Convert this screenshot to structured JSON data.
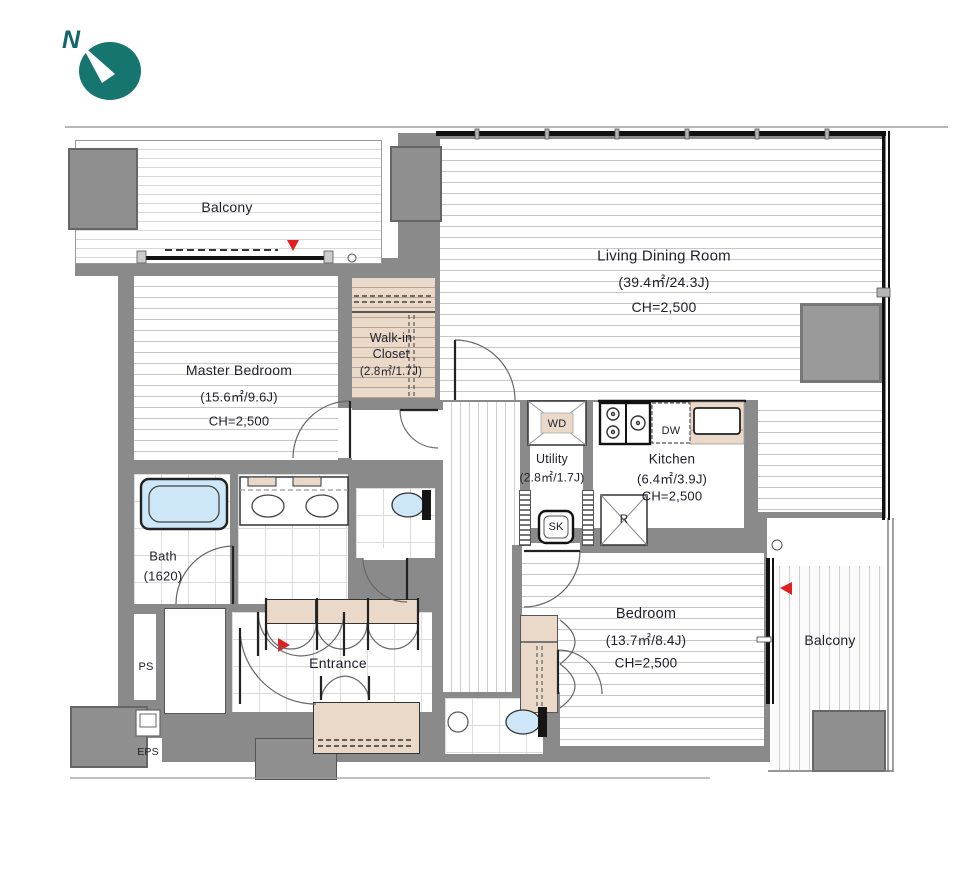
{
  "compass": {
    "label": "N"
  },
  "rooms": {
    "balcony_top": {
      "name": "Balcony"
    },
    "living_dining": {
      "name": "Living Dining Room",
      "area": "(39.4㎡/24.3J)",
      "ceiling_height": "CH=2,500"
    },
    "master_bedroom": {
      "name": "Master Bedroom",
      "area": "(15.6㎡/9.6J)",
      "ceiling_height": "CH=2,500"
    },
    "walk_in_closet": {
      "name_line1": "Walk-in",
      "name_line2": "Closet",
      "area": "(2.8㎡/1.7J)"
    },
    "utility": {
      "name": "Utility",
      "area": "(2.8㎡/1.7J)"
    },
    "kitchen": {
      "name": "Kitchen",
      "area": "(6.4㎡/3.9J)",
      "ceiling_height": "CH=2,500"
    },
    "bath": {
      "name": "Bath",
      "size": "(1620)"
    },
    "entrance": {
      "name": "Entrance"
    },
    "bedroom": {
      "name": "Bedroom",
      "area": "(13.7㎡/8.4J)",
      "ceiling_height": "CH=2,500"
    },
    "balcony_right": {
      "name": "Balcony"
    },
    "ps": {
      "name": "PS"
    },
    "eps": {
      "name": "EPS"
    }
  },
  "fixtures": {
    "washer_dryer": "WD",
    "dishwasher": "DW",
    "slop_sink": "SK",
    "refrigerator": "R"
  },
  "colors": {
    "wall": "#8a8a8a",
    "counter_beige": "#ead9c8",
    "fixture_blue": "#cde7f8",
    "compass_teal": "#16766f",
    "arrow_red": "#e02020"
  }
}
